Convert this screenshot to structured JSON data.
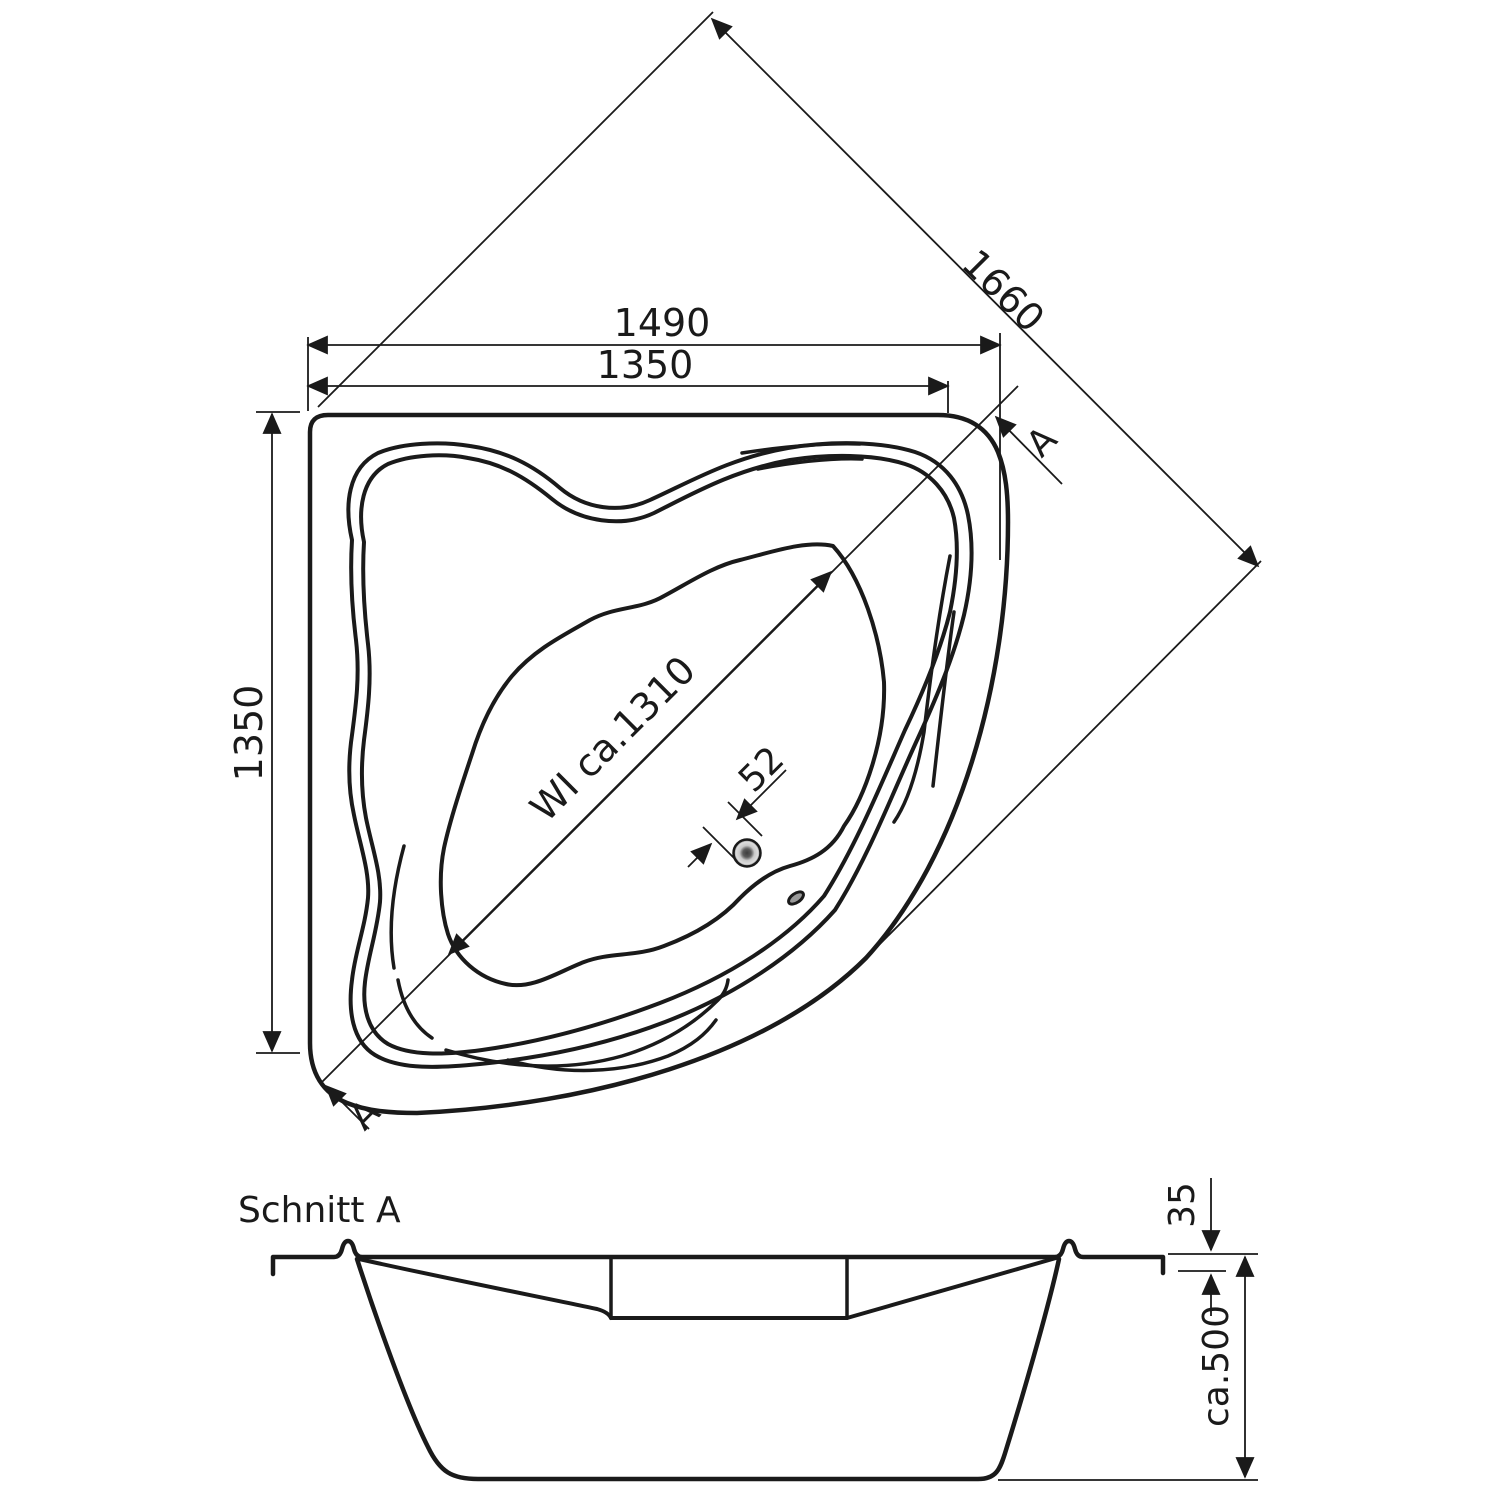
{
  "colors": {
    "ink": "#1a1a1a",
    "background": "#ffffff",
    "drain_center": "#3c3c3c",
    "drain_mid": "#c8c8c8",
    "drain_outer": "#2e2e2e",
    "overflow_fill": "#9a9a9a"
  },
  "plan_view": {
    "dim_overall_width": "1490",
    "dim_wall_width": "1350",
    "dim_wall_height": "1350",
    "dim_diagonal": "1660",
    "dim_inner_diagonal": "WI ca.1310",
    "dim_drain": "52",
    "section_marker_top": "A",
    "section_marker_bottom": "A"
  },
  "section_view": {
    "title": "Schnitt A",
    "dim_rim_height": "35",
    "dim_depth": "ca.500"
  }
}
